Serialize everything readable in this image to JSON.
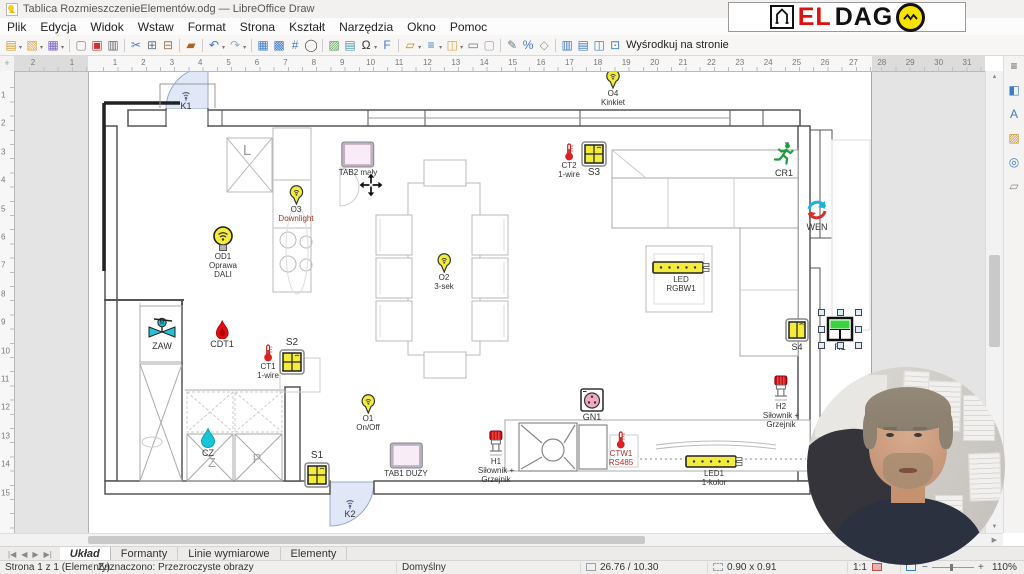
{
  "window": {
    "title": "Tablica RozmieszczenieElementów.odg — LibreOffice Draw",
    "controls": [
      "maximize",
      "close"
    ]
  },
  "menubar": {
    "items": [
      "Plik",
      "Edycja",
      "Widok",
      "Wstaw",
      "Format",
      "Strona",
      "Kształt",
      "Narzędzia",
      "Okno",
      "Pomoc"
    ]
  },
  "toolbar": {
    "center_label": "Wyśrodkuj na stronie",
    "icons": [
      {
        "n": "new-document",
        "g": "▤",
        "c": "#d29a2a",
        "car": true
      },
      {
        "n": "open-file",
        "g": "▧",
        "c": "#e0a23c",
        "car": true
      },
      {
        "n": "save",
        "g": "▦",
        "c": "#7a5fc0",
        "car": true
      },
      {
        "sep": true
      },
      {
        "n": "new-blank",
        "g": "▢",
        "c": "#888888"
      },
      {
        "n": "export-pdf",
        "g": "▣",
        "c": "#cc3333"
      },
      {
        "n": "print",
        "g": "▥",
        "c": "#666677"
      },
      {
        "sep": true
      },
      {
        "n": "cut",
        "g": "✂",
        "c": "#3d7cc9"
      },
      {
        "n": "copy",
        "g": "⊞",
        "c": "#667788"
      },
      {
        "n": "paste",
        "g": "⊟",
        "c": "#997755"
      },
      {
        "sep": true
      },
      {
        "n": "clone-formatting",
        "g": "▰",
        "c": "#b06020"
      },
      {
        "sep": true
      },
      {
        "n": "undo",
        "g": "↶",
        "c": "#3d7cc9",
        "car": true
      },
      {
        "n": "redo",
        "g": "↷",
        "c": "#99aabb",
        "car": true
      },
      {
        "sep": true
      },
      {
        "n": "display-grid",
        "g": "▦",
        "c": "#3d7cc9"
      },
      {
        "n": "snap-guides",
        "g": "▩",
        "c": "#3d7cc9"
      },
      {
        "n": "helplines",
        "g": "#",
        "c": "#3d7cc9"
      },
      {
        "n": "zoom",
        "g": "◯",
        "c": "#555555"
      },
      {
        "sep": true
      },
      {
        "n": "insert-image",
        "g": "▨",
        "c": "#55a055"
      },
      {
        "n": "insert-chart",
        "g": "▤",
        "c": "#4499aa"
      },
      {
        "n": "special-character",
        "g": "Ω",
        "c": "#333333",
        "car": true
      },
      {
        "n": "fontwork",
        "g": "F",
        "c": "#3d7cc9"
      },
      {
        "sep": true
      },
      {
        "n": "transformations",
        "g": "▱",
        "c": "#cc8800",
        "car": true
      },
      {
        "n": "align-objects",
        "g": "≡",
        "c": "#3d7cc9",
        "car": true
      },
      {
        "n": "arrange",
        "g": "◫",
        "c": "#e8a33d",
        "car": true
      },
      {
        "n": "line-and-filling",
        "g": "▭",
        "c": "#667788"
      },
      {
        "n": "select",
        "g": "▢",
        "c": "#99aabb"
      },
      {
        "sep": true
      },
      {
        "n": "edit-points",
        "g": "✎",
        "c": "#667788"
      },
      {
        "n": "glue-points",
        "g": "%",
        "c": "#3d7cc9"
      },
      {
        "n": "toggle-extrusion",
        "g": "◇",
        "c": "#8899aa"
      },
      {
        "sep": true
      },
      {
        "n": "distribute-horizontally",
        "g": "▥",
        "c": "#3d7cc9"
      },
      {
        "n": "distribute-vertically",
        "g": "▤",
        "c": "#3d7cc9"
      },
      {
        "n": "center-horizontally",
        "g": "◫",
        "c": "#3d7cc9"
      },
      {
        "n": "center-on-page",
        "g": "⊡",
        "c": "#3d7cc9"
      }
    ]
  },
  "logo": {
    "el": "EL",
    "dag": "DAG",
    "o": "O"
  },
  "rulers": {
    "h_negative": [
      2,
      1
    ],
    "h_numbers": [
      1,
      2,
      3,
      4,
      5,
      6,
      7,
      8,
      9,
      10,
      11,
      12,
      13,
      14,
      15,
      16,
      17,
      18,
      19,
      20,
      21,
      22,
      23,
      24,
      25,
      26,
      27
    ],
    "h_margin_numbers": [
      28,
      29,
      30,
      31
    ],
    "v_numbers": [
      1,
      2,
      3,
      4,
      5,
      6,
      7,
      8,
      9,
      10,
      11,
      12,
      13,
      14,
      15
    ]
  },
  "canvas": {
    "rooms": [
      {
        "t": "L",
        "x": 247,
        "y": 142,
        "size": 15,
        "color": "#9a9a9a"
      },
      {
        "t": "Z",
        "x": 212,
        "y": 455,
        "size": 13,
        "color": "#a5a5a5"
      },
      {
        "t": "P",
        "x": 257,
        "y": 451,
        "size": 13,
        "color": "#a5a5a5"
      }
    ],
    "devices": [
      {
        "id": "K1",
        "type": "door-sensor",
        "x": 186,
        "y": 90,
        "labels": [
          "K1"
        ],
        "labelSize": 9
      },
      {
        "id": "O4",
        "type": "lamp-pin",
        "x": 613,
        "y": 69,
        "labels": [
          "O4",
          "Kinkiet"
        ]
      },
      {
        "id": "CT2",
        "type": "thermometer",
        "x": 569,
        "y": 143,
        "labels": [
          "CT2",
          "1-wire"
        ]
      },
      {
        "id": "S3",
        "type": "switch4",
        "x": 594,
        "y": 141,
        "labels": [
          "S3"
        ],
        "labelSize": 10
      },
      {
        "id": "CR1",
        "type": "running-man",
        "x": 784,
        "y": 142,
        "labels": [
          "CR1"
        ],
        "labelSize": 9
      },
      {
        "id": "WEN",
        "type": "vent",
        "x": 817,
        "y": 198,
        "labels": [
          "WEN"
        ],
        "labelSize": 9
      },
      {
        "id": "TAB2",
        "type": "tablet",
        "x": 358,
        "y": 141,
        "labels": [
          "TAB2 mały"
        ]
      },
      {
        "id": "MOVE",
        "type": "move-cursor",
        "x": 371,
        "y": 172,
        "labels": []
      },
      {
        "id": "O3",
        "type": "lamp-pin",
        "x": 296,
        "y": 185,
        "labels": [
          "O3",
          "Downlight"
        ],
        "labelColors": [
          "#333333",
          "#a03a2a"
        ]
      },
      {
        "id": "OD1",
        "type": "bulb",
        "x": 223,
        "y": 226,
        "labels": [
          "OD1",
          "Oprawa",
          "DALI"
        ]
      },
      {
        "id": "O2",
        "type": "lamp-pin",
        "x": 444,
        "y": 253,
        "labels": [
          "O2",
          "3-sek"
        ]
      },
      {
        "id": "LED_RGBW1",
        "type": "led-strip",
        "x": 681,
        "y": 260,
        "labels": [
          "LED",
          "RGBW1"
        ]
      },
      {
        "id": "ZAW",
        "type": "valve",
        "x": 162,
        "y": 317,
        "labels": [
          "ZAW"
        ],
        "labelSize": 9
      },
      {
        "id": "CDT1",
        "type": "flame",
        "x": 222,
        "y": 320,
        "labels": [
          "CDT1"
        ],
        "labelSize": 9
      },
      {
        "id": "CT1",
        "type": "thermometer",
        "x": 268,
        "y": 344,
        "labels": [
          "CT1",
          "1-wire"
        ]
      },
      {
        "id": "S2",
        "type": "switch4",
        "x": 292,
        "y": 349,
        "labels": [
          "S2"
        ],
        "labelPos": "above",
        "labelSize": 10
      },
      {
        "id": "S4",
        "type": "switch2",
        "x": 797,
        "y": 318,
        "labels": [
          "S4"
        ],
        "labelSize": 9
      },
      {
        "id": "R1",
        "type": "relay",
        "x": 840,
        "y": 316,
        "labels": [
          "R1"
        ],
        "selected": true,
        "labelSize": 9
      },
      {
        "id": "O1",
        "type": "lamp-pin",
        "x": 368,
        "y": 394,
        "labels": [
          "O1",
          "On/Off"
        ]
      },
      {
        "id": "GN1",
        "type": "socket",
        "x": 592,
        "y": 388,
        "labels": [
          "GN1"
        ],
        "labelSize": 9
      },
      {
        "id": "H2",
        "type": "actuator",
        "x": 781,
        "y": 375,
        "labels": [
          "H2",
          "Siłownik +",
          "Grzejnik"
        ]
      },
      {
        "id": "CZ",
        "type": "drop",
        "x": 208,
        "y": 428,
        "labels": [
          "CZ"
        ],
        "labelSize": 9
      },
      {
        "id": "S1",
        "type": "switch4",
        "x": 317,
        "y": 462,
        "labels": [
          "S1"
        ],
        "labelPos": "above",
        "labelSize": 10
      },
      {
        "id": "TAB1",
        "type": "tablet",
        "x": 406,
        "y": 442,
        "labels": [
          "TAB1 DUŻY"
        ]
      },
      {
        "id": "H1",
        "type": "actuator",
        "x": 496,
        "y": 430,
        "labels": [
          "H1",
          "Siłownik +",
          "Grzejnik"
        ]
      },
      {
        "id": "CTW1",
        "type": "thermometer",
        "x": 621,
        "y": 431,
        "labels": [
          "CTW1",
          "RS485"
        ],
        "labelColors": [
          "#b03030",
          "#b03030"
        ]
      },
      {
        "id": "LED1",
        "type": "led-strip",
        "x": 714,
        "y": 454,
        "labels": [
          "LED1",
          "1-kolor"
        ]
      },
      {
        "id": "K2",
        "type": "door-sensor",
        "x": 350,
        "y": 498,
        "labels": [
          "K2"
        ],
        "labelSize": 9
      }
    ]
  },
  "sidebar": {
    "icons": [
      {
        "name": "sidebar-settings-icon",
        "glyph": "≡",
        "color": "#555555"
      },
      {
        "name": "properties-icon",
        "glyph": "◧",
        "color": "#3d7cc9"
      },
      {
        "name": "styles-icon",
        "glyph": "A",
        "color": "#3d7cc9"
      },
      {
        "name": "gallery-icon",
        "glyph": "▨",
        "color": "#c8922f"
      },
      {
        "name": "navigator-icon",
        "glyph": "◎",
        "color": "#3d7cc9"
      },
      {
        "name": "shapes-icon",
        "glyph": "▱",
        "color": "#888888"
      }
    ]
  },
  "layer_tabs": {
    "nav": [
      {
        "name": "first-layer",
        "glyph": "|◀"
      },
      {
        "name": "previous-layer",
        "glyph": "◀"
      },
      {
        "name": "next-layer",
        "glyph": "▶"
      },
      {
        "name": "last-layer",
        "glyph": "▶|"
      }
    ],
    "items": [
      "Układ",
      "Formanty",
      "Linie wymiarowe",
      "Elementy"
    ],
    "active": 0
  },
  "statusbar": {
    "page": "Strona 1 z 1 (Elementy)",
    "selection": "Zaznaczono: Przezroczyste obrazy",
    "style": "Domyślny",
    "position": "26.76 / 10.30",
    "size": "0.90 x 0.91",
    "ratio": "1:1",
    "zoom_minus": "−",
    "zoom_plus": "+",
    "zoom": "110%"
  }
}
